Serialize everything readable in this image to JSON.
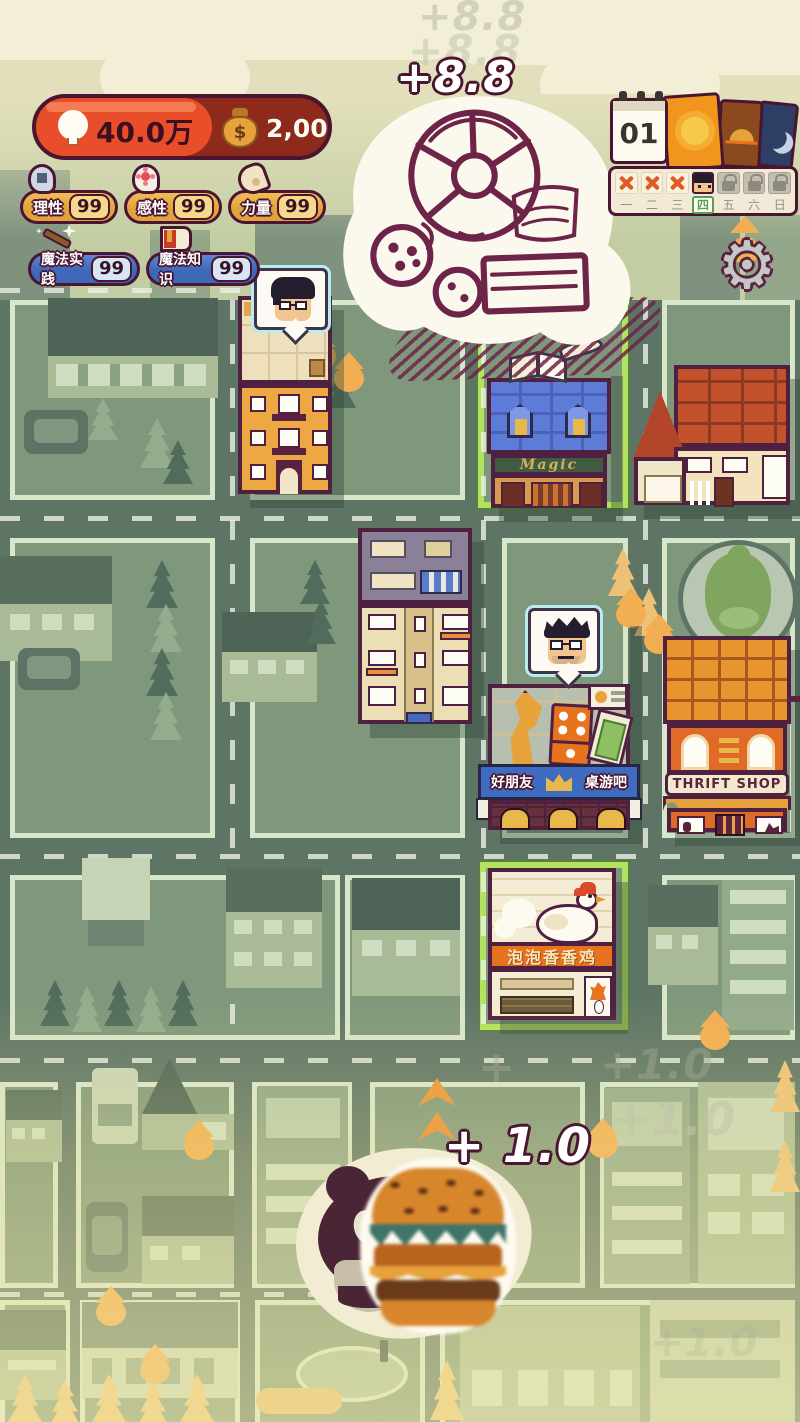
{
  "hud": {
    "insight_gain": "+8.8",
    "insight_gain_ghost": "+8.8",
    "insight_value": "40.0万",
    "insight_icon": "lightbulb",
    "money_value": "2,000",
    "money_bag_symbol": "$",
    "stats": [
      {
        "label": "理性",
        "value": "99",
        "icon": "head-gear"
      },
      {
        "label": "感性",
        "value": "99",
        "icon": "head-flower"
      },
      {
        "label": "力量",
        "value": "99",
        "icon": "arm-muscle"
      }
    ],
    "magic_stats": [
      {
        "label": "魔法实践",
        "value": "99",
        "icon": "magic-wand"
      },
      {
        "label": "魔法知识",
        "value": "99",
        "icon": "spell-book"
      }
    ],
    "calendar": {
      "day": "01",
      "phase_cards": [
        "sun",
        "sunset",
        "moon"
      ],
      "day_slots": [
        "x",
        "x",
        "x",
        "avatar",
        "lock",
        "lock",
        "lock"
      ],
      "week_days": [
        "一",
        "二",
        "三",
        "四",
        "五",
        "六",
        "日"
      ],
      "active_week_day": "四"
    },
    "settings_glyph": "⚙"
  },
  "map": {
    "signs": {
      "magic_shop": "Magic",
      "thrift_shop": "THRIFT SHOP",
      "cafe_banner_left": "好朋友",
      "cafe_banner_right": "桌游吧",
      "chicken_shop": "泡泡香香鸡"
    },
    "bottom_gain": "+ 1.0",
    "bottom_gain_ghost": "+1.0",
    "plus_ghost": "+"
  },
  "colors": {
    "hud_orange": "#e84e2a",
    "hud_dark_red": "#8e2a1c",
    "outline_ink": "#4a1530",
    "gold": "#e2a33c",
    "blue": "#3e68b8",
    "lot_green": "#7f977b",
    "road_green": "#5e7566",
    "highlight_green": "#b2e35e",
    "drop_orange": "#f2ae52"
  }
}
